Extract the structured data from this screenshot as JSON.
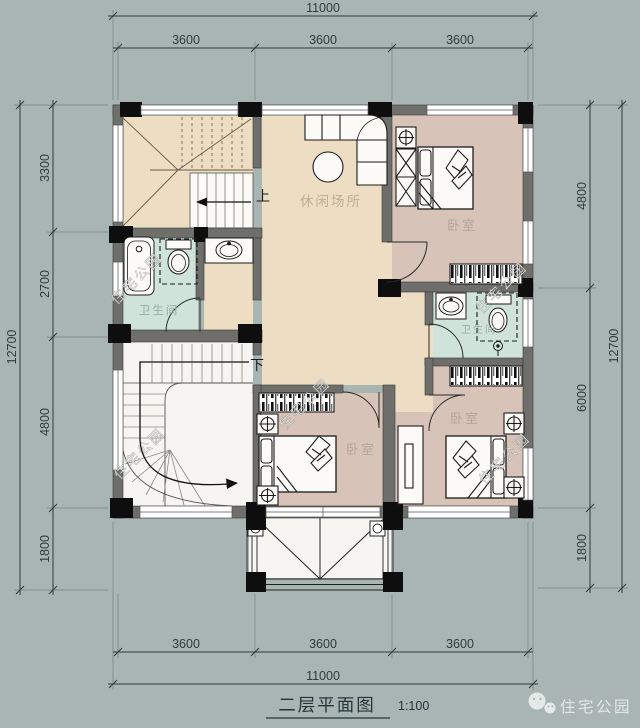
{
  "page": {
    "width": 640,
    "height": 728
  },
  "title": {
    "text": "二层平面图",
    "scale": "1:100"
  },
  "brand": {
    "watermark": "住宅公园",
    "logo_icon": "wechat-bubbles-icon"
  },
  "dimensions": {
    "top": {
      "total": "11000",
      "segments": [
        "3600",
        "3600",
        "3600"
      ]
    },
    "bottom": {
      "total": "11000",
      "segments": [
        "3600",
        "3600",
        "3600"
      ]
    },
    "left": {
      "total": "12700",
      "segments": [
        "3300",
        "2700",
        "4800",
        "1800"
      ]
    },
    "right": {
      "total": "12700",
      "segments": [
        "4800",
        "6000",
        "1800"
      ]
    }
  },
  "rooms": {
    "leisure": "休闲场所",
    "bedroom": "卧室",
    "bathroom": "卫生间"
  },
  "stairs": {
    "up": "上",
    "down": "下"
  },
  "colors": {
    "background": "#a9b5b2",
    "floor_main": "#ecddc3",
    "floor_bedroom": "#d7c3b8",
    "floor_bathroom": "#cfe3da",
    "wall": "#6e6e6b",
    "column": "#0e0e0e",
    "dimension_text": "#2e3a3e",
    "watermark": "#fcfcfa"
  }
}
